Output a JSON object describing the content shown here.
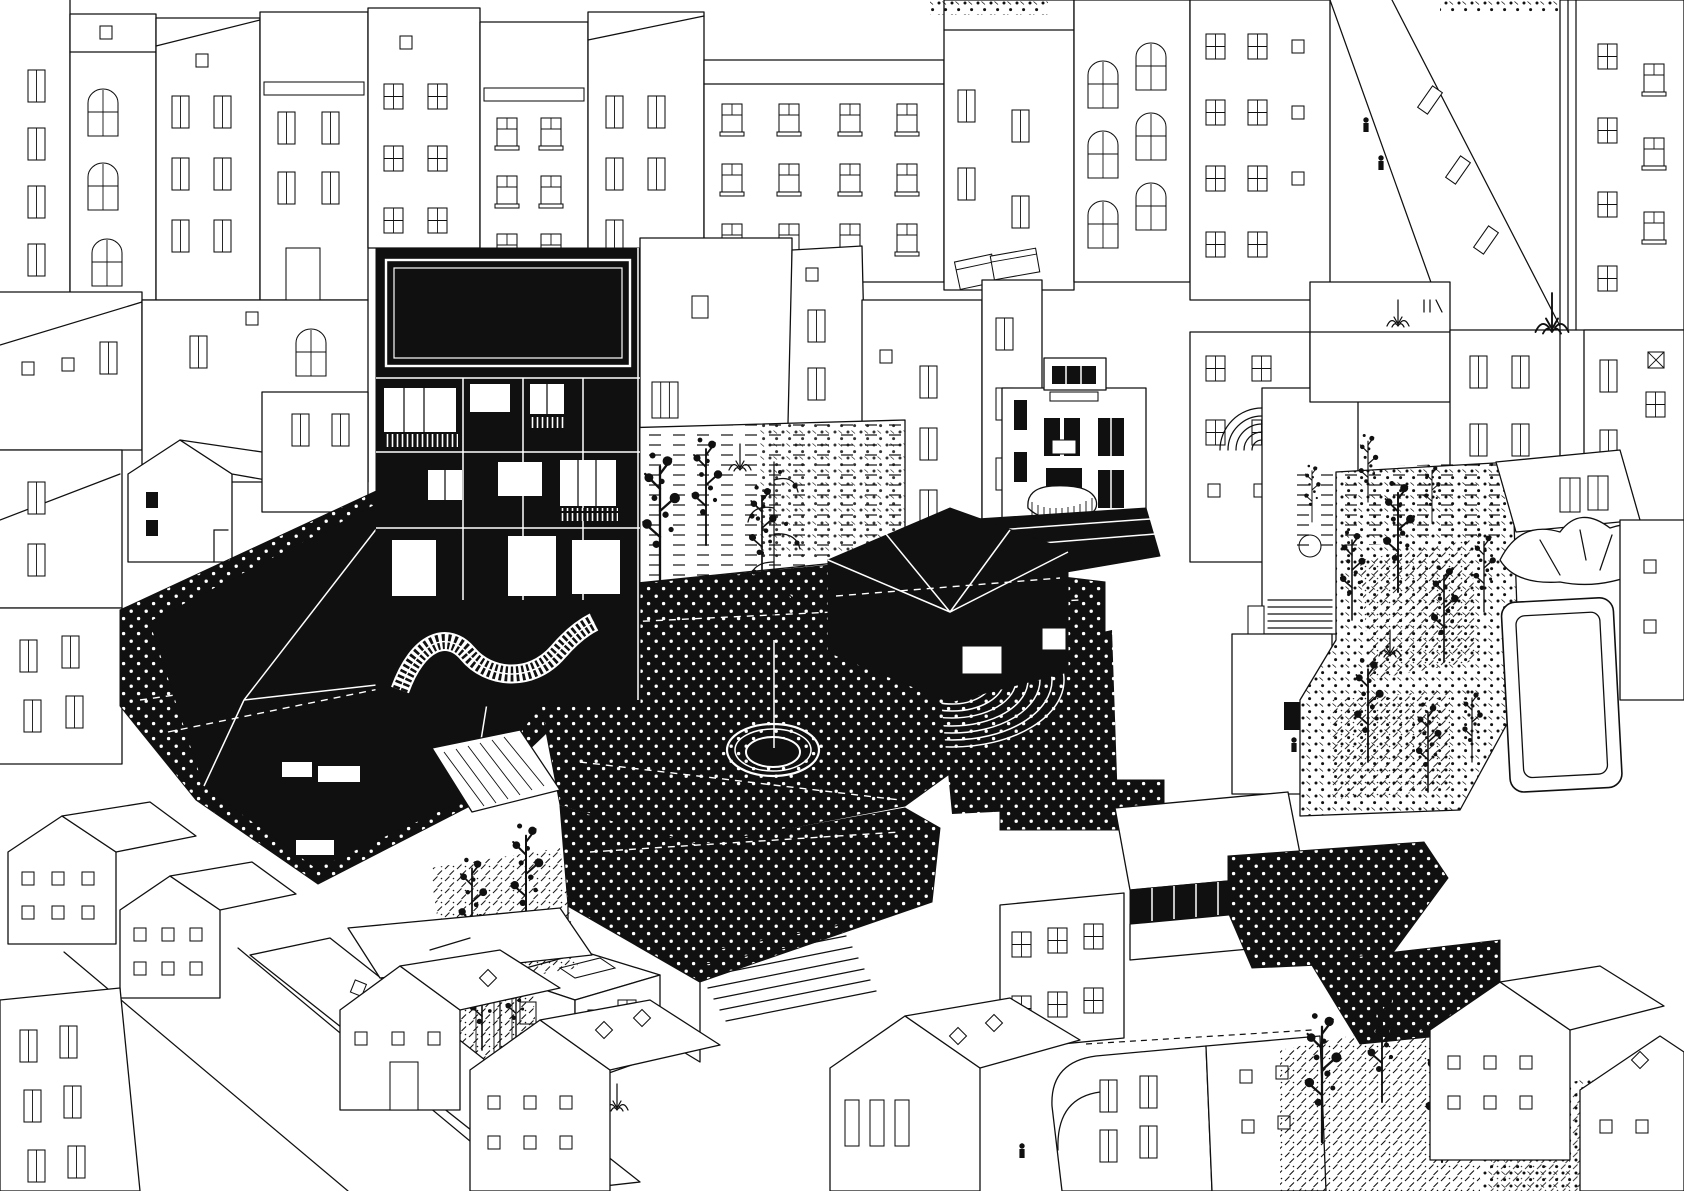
{
  "scene": {
    "description": "Black and white axonometric architectural drawing of a dense city block: a dark courtyard project with a dotted plaza, circular fountain, open-air amphitheatre, faceted black pavilion roof and a black infill building with a winding balcony, surrounded by white line-drawn housing facades, gabled roofs, planted courtyards, slender trees and a rooftop pool.",
    "technique": "ink on paper, line drawing with stipple and hatch textures",
    "elements": [
      "city-facade-row",
      "billboard-building",
      "winding-balcony",
      "faceted-pavilion",
      "dotted-plaza",
      "fountain-ring",
      "spiral-tree",
      "amphitheatre",
      "hipped-pavilion",
      "planting-terrace",
      "white-villa",
      "arched-stair-building",
      "right-courtyard",
      "courtyard-trees",
      "rooftop-pool",
      "crumpled-canopy",
      "street-canyon",
      "pedestrians",
      "gabled-houses",
      "diamond-skylights",
      "outdoor-stair",
      "glazed-band-hall",
      "rounded-corner-building",
      "espalier-garden",
      "hatch-gardens",
      "crosswalk"
    ]
  },
  "colors": {
    "ink": "#101010",
    "paper": "#ffffff"
  }
}
